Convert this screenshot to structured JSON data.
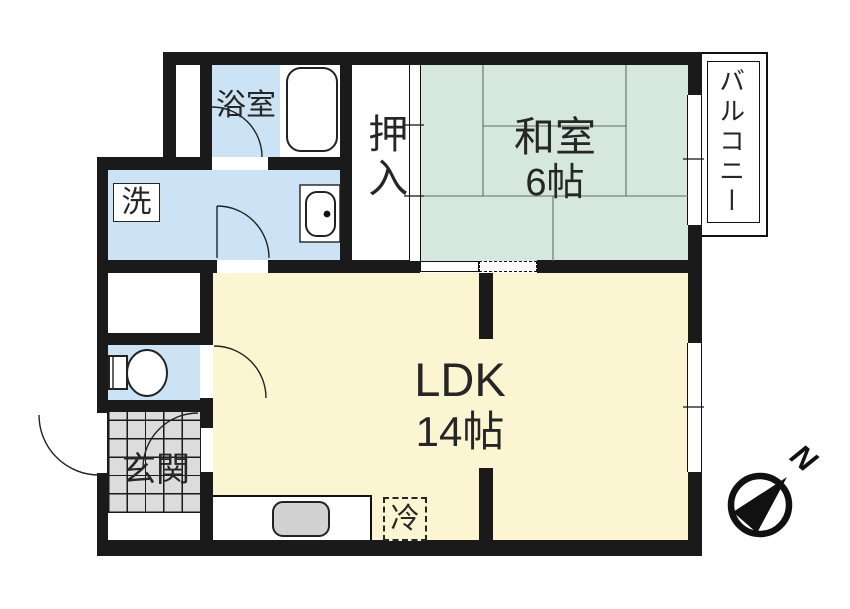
{
  "rooms": {
    "bathroom": {
      "label": "浴室"
    },
    "washroom": {
      "label": "洗"
    },
    "closet": {
      "label": "押入"
    },
    "japanese_room": {
      "label": "和室",
      "size": "6帖"
    },
    "balcony": {
      "label": "バルコニー"
    },
    "ldk": {
      "label": "LDK",
      "size": "14帖"
    },
    "entrance": {
      "label": "玄関"
    },
    "refrigerator": {
      "label": "冷"
    }
  },
  "compass": {
    "north_label": "N"
  },
  "colors": {
    "wall": "#1a1a1a",
    "wet_area_blue": "#cbe3f4",
    "tatami_green": "#d6e8dd",
    "ldk_yellow": "#fbf5d2",
    "tile_gray": "#dcdcdc",
    "fixture_gray": "#d2d2d2"
  }
}
